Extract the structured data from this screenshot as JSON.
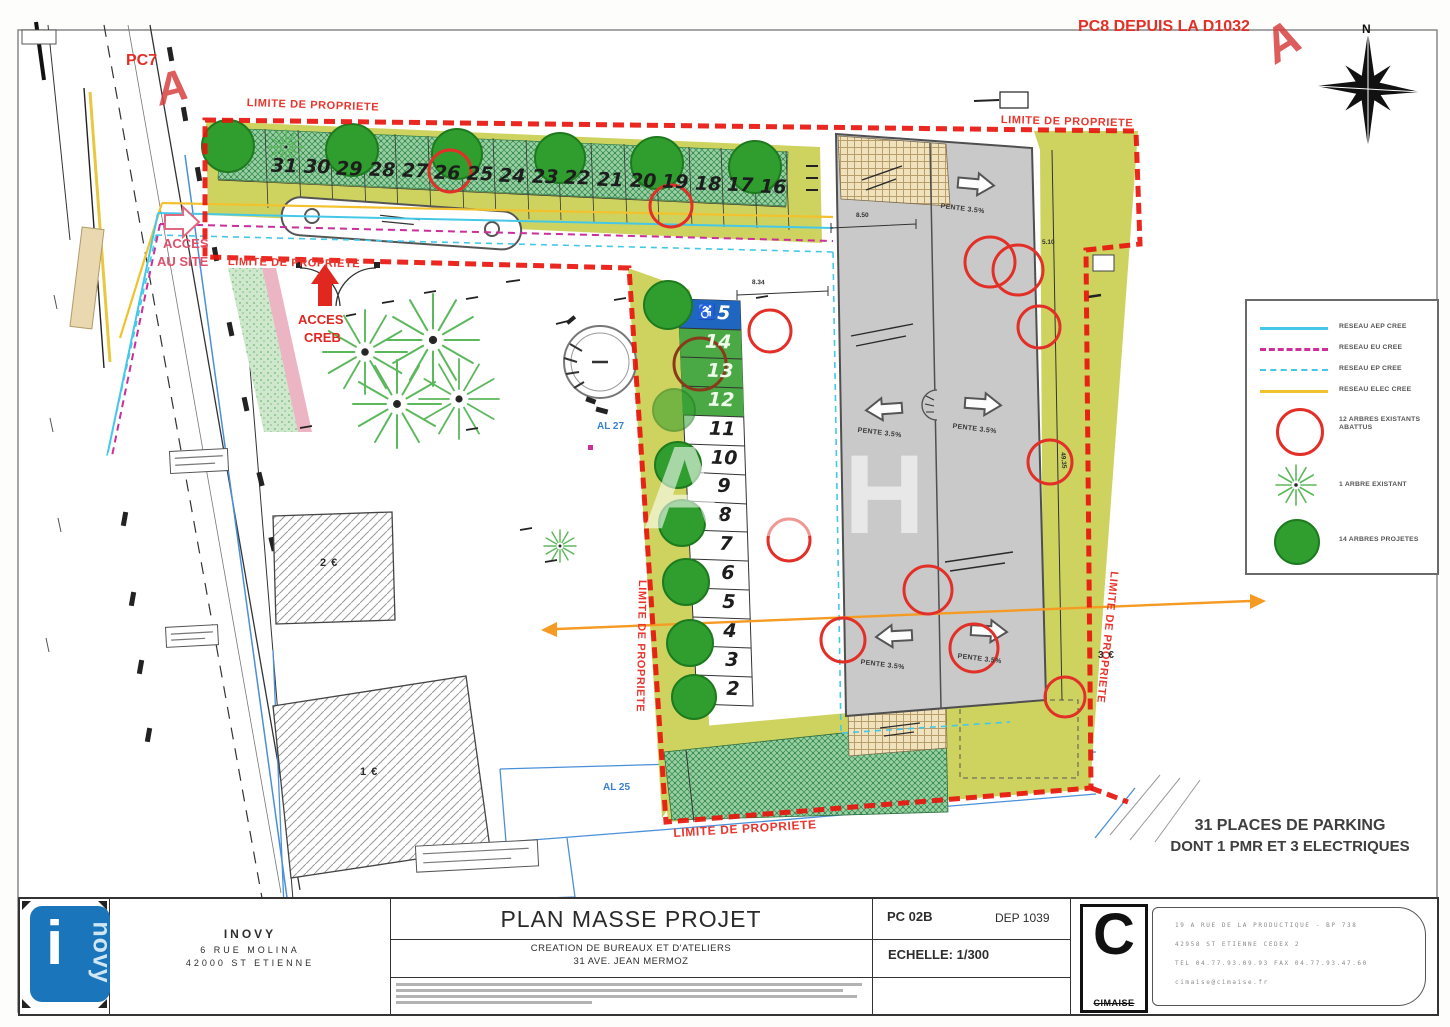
{
  "plan": {
    "pc7_label": "PC7",
    "pc8_label": "PC8 DEPUIS LA D1032",
    "view_marker": "A",
    "north_label": "N",
    "acces_site_line1": "ACCES",
    "acces_site_line2": "AU SITE",
    "acces_creb_line1": "ACCES",
    "acces_creb_line2": "CREB",
    "limite_label": "LIMITE DE PROPRIETE",
    "al27_label": "AL 27",
    "al25_label": "AL 25",
    "building1_label": "1 €",
    "building2_label": "2 €",
    "building3_label": "3 €",
    "pente_label": "PENTE 3.5%",
    "dim_850": "8.50",
    "dim_834": "8.34",
    "dim_510": "5.10",
    "dim_4935": "49.35",
    "parking_note_line1": "31 PLACES DE PARKING",
    "parking_note_line2": "DONT 1 PMR ET 3 ELECTRIQUES",
    "wheelchair_icon": "♿",
    "top_row_numbers": [
      "31",
      "30",
      "29",
      "28",
      "27",
      "26",
      "25",
      "24",
      "23",
      "22",
      "21",
      "20",
      "19",
      "18",
      "17",
      "16"
    ],
    "column_numbers": [
      "15",
      "14",
      "13",
      "12",
      "11",
      "10",
      "9",
      "8",
      "7",
      "6",
      "5",
      "4",
      "3",
      "2"
    ]
  },
  "legend": {
    "line_items": [
      {
        "label": "RESEAU AEP CREE",
        "color": "#45c8e8",
        "style": "solid"
      },
      {
        "label": "RESEAU EU CREE",
        "color": "#cc2e9a",
        "style": "dashed"
      },
      {
        "label": "RESEAU EP CREE",
        "color": "#45c8e8",
        "style": "dashed"
      },
      {
        "label": "RESEAU ELEC CREE",
        "color": "#f2c12e",
        "style": "solid"
      }
    ],
    "tree_items": [
      {
        "label": "12 ARBRES EXISTANTS ABATTUS",
        "symbol": "red-circle"
      },
      {
        "label": "1 ARBRE EXISTANT",
        "symbol": "existing-tree"
      },
      {
        "label": "14 ARBRES PROJETES",
        "symbol": "projected-tree"
      }
    ]
  },
  "titleblock": {
    "client_name": "INOVY",
    "client_addr1": "6 RUE MOLINA",
    "client_addr2": "42000 ST ETIENNE",
    "logo_i": "i",
    "logo_novy": "novy",
    "title": "PLAN MASSE PROJET",
    "subtitle1": "CREATION DE BUREAUX ET D'ATELIERS",
    "subtitle2": "31 AVE. JEAN MERMOZ",
    "doc_num": "PC 02B",
    "dep_num": "DEP 1039",
    "scale": "ECHELLE: 1/300",
    "firm_logo": "C",
    "firm_name": "CIMAISE",
    "firm_line1": "19 A RUE DE LA PRODUCTIQUE - BP 738",
    "firm_line2": "42958 ST ETIENNE CEDEX 2",
    "firm_line3": "TEL 04.77.93.09.93  FAX 04.77.93.47.60",
    "firm_line4": "cimaise@cimaise.fr"
  },
  "colors": {
    "boundary_red": "#e8150d",
    "pmr_blue": "#1e66c0",
    "electric_green": "#4aa845",
    "tree_green": "#2f9e2f",
    "reseau_aep": "#45c8e8",
    "reseau_eu": "#cc2e9a",
    "reseau_elec": "#f2c12e",
    "orange_axis": "#f59a23",
    "olive_area": "#ced35f",
    "ramp_gray": "#c9c9c9",
    "inovy_blue": "#1b75bb"
  }
}
